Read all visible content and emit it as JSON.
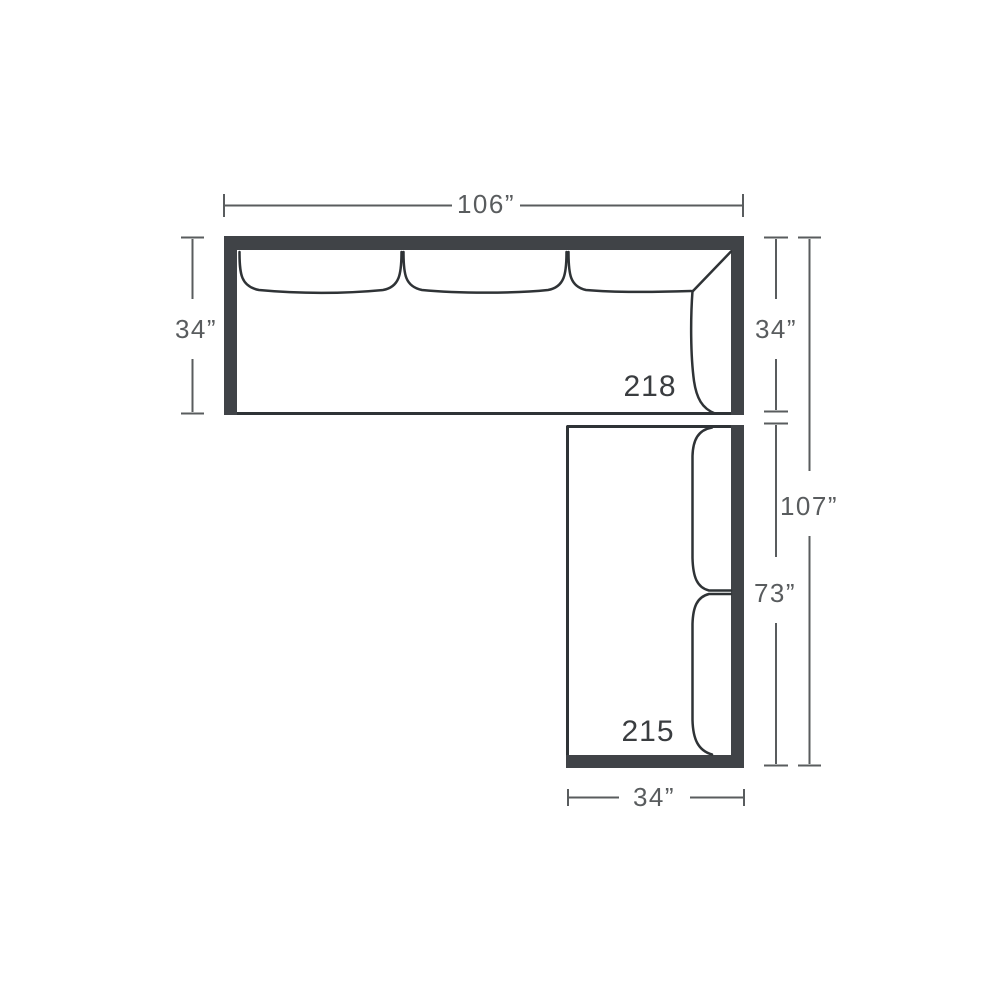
{
  "colors": {
    "frame": "#404347",
    "outline": "#2f3336",
    "dimension": "#595c5e",
    "label": "#3a3d40",
    "background": "#ffffff"
  },
  "pieces": {
    "top_sofa_label": "218",
    "side_sofa_label": "215"
  },
  "dimensions": {
    "top_width": "106”",
    "left_depth": "34”",
    "right_depth": "34”",
    "right_overall_height": "107”",
    "side_length": "73”",
    "bottom_width": "34”"
  }
}
